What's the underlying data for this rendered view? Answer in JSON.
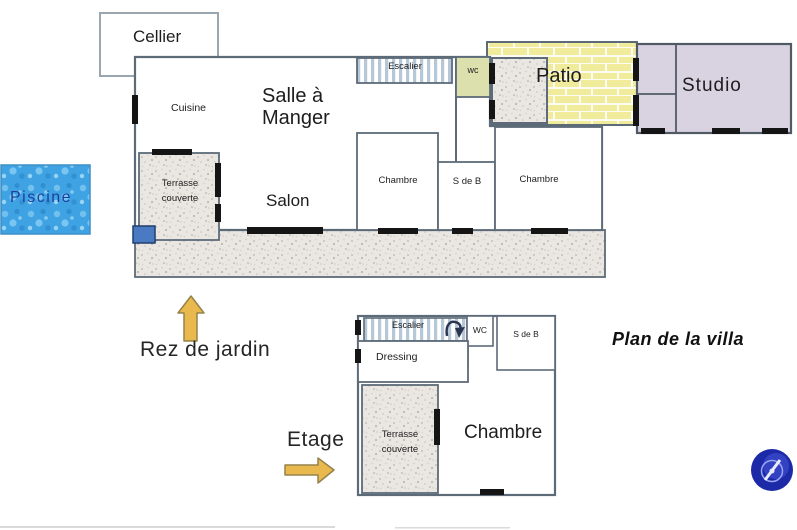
{
  "title": "Plan de la villa",
  "captions": {
    "ground": "Rez de jardin",
    "upper": "Etage"
  },
  "ground_floor": {
    "cellier": "Cellier",
    "cuisine": "Cuisine",
    "dining_line1": "Salle à",
    "dining_line2": "Manger",
    "salon": "Salon",
    "escalier": "Escalier",
    "wc": "wc",
    "patio": "Patio",
    "studio": "Studio",
    "chambre_left": "Chambre",
    "sdb": "S de B",
    "chambre_right": "Chambre",
    "terrasse_line1": "Terrasse",
    "terrasse_line2": "couverte",
    "piscine": "Piscine"
  },
  "upper_floor": {
    "escalier": "Escalier",
    "wc": "WC",
    "sdb": "S de B",
    "dressing": "Dressing",
    "terrasse_line1": "Terrasse",
    "terrasse_line2": "couverte",
    "chambre": "Chambre"
  },
  "colors": {
    "wall": "#5d6b79",
    "patio_fill": "#f1eb9c",
    "studio_fill": "#d9d3e1",
    "wc_fill": "#dce0ad",
    "water": "#3fa3e3",
    "texture_base": "#eae6e1",
    "stairs_stripe": "#b6c7d7",
    "arrow": "#e9b94d",
    "door_marker": "#151515",
    "pool_label": "#1c3f9e",
    "pool_square": "#4a7ac2",
    "logo_blue": "#1c2aa8"
  }
}
